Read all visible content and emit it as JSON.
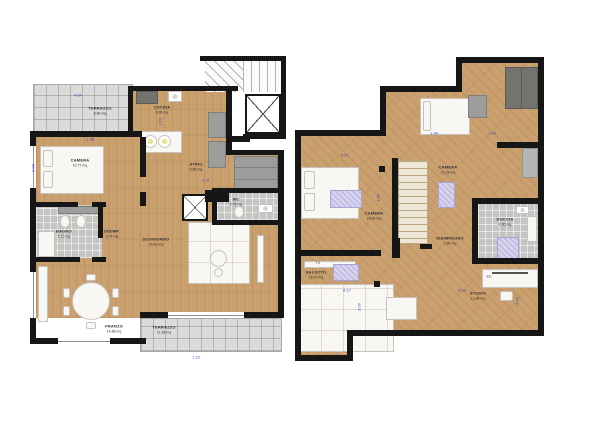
{
  "plans": {
    "left": {
      "rooms": [
        {
          "name": "TERRAZZO",
          "area": "8.80 mq"
        },
        {
          "name": "CUCINA",
          "area": "8.86 mq"
        },
        {
          "name": "CAMERA",
          "area": "10.77 mq"
        },
        {
          "name": "BAGNO",
          "area": "4.13 mq"
        },
        {
          "name": "DISIMP.",
          "area": "3.74 mq"
        },
        {
          "name": "PRANZO",
          "area": "14.85 mq"
        },
        {
          "name": "SOGGIORNO",
          "area": "20.60 mq"
        },
        {
          "name": "ATRIO",
          "area": "5.80 mq"
        },
        {
          "name": "WC",
          "area": "2.05 mq"
        },
        {
          "name": "TERRAZZO",
          "area": "11.38 mq"
        }
      ],
      "dimensions": [
        "4.04",
        "3.08",
        "1.98",
        "1.70",
        "1.91",
        "1.16"
      ]
    },
    "right": {
      "rooms": [
        {
          "name": "CAMERA",
          "area": "18.36 mq"
        },
        {
          "name": "CAMERA",
          "area": "21.28 mq"
        },
        {
          "name": "DISIMPEGNO",
          "area": "5.86 mq"
        },
        {
          "name": "DOCCIA",
          "area": "4.86 mq"
        },
        {
          "name": "SALOTTO",
          "area": "16.70 mq"
        },
        {
          "name": "STUDIO",
          "area": "13.85 mq"
        }
      ],
      "dimensions": [
        "4.07",
        "1.44",
        "1.60",
        "3.05",
        "6.17",
        "3.06",
        "3.09",
        "2.45"
      ],
      "furniture_labels": {
        "tv": "TV",
        "pc": "PC"
      }
    },
    "colors": {
      "wall": "#161616",
      "wood_floor": "#c9a06e",
      "terrace": "#dbdbd9",
      "tile": "#c4c4c2",
      "rug": "#c7c1e6",
      "dimension_text": "#4343c9",
      "label_text": "#2f2f2f"
    }
  }
}
